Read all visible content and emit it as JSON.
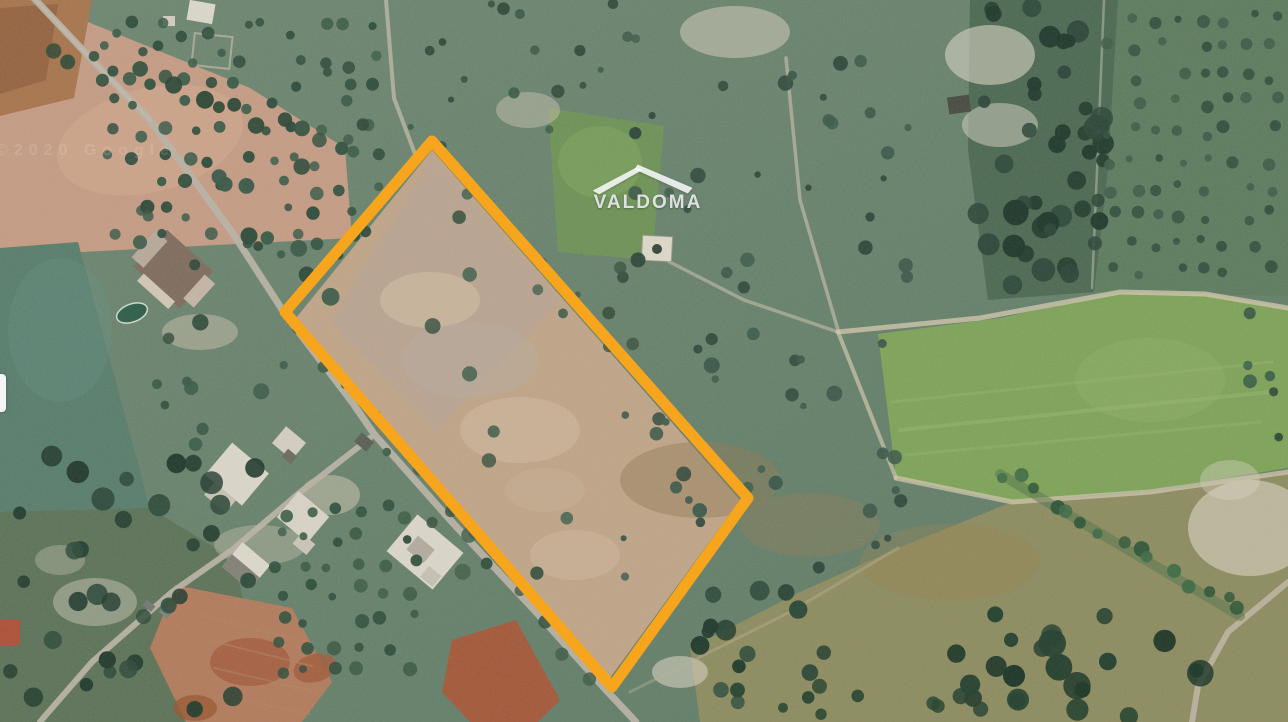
{
  "watermark": {
    "logo_text": "VALDOMA",
    "logo_icon": "roof-icon",
    "color": "#FFFFFF"
  },
  "imagery_credit": {
    "text": "©2020 Google"
  },
  "parcel_outline": {
    "shape": "quadrilateral",
    "color": "#F7A51D",
    "stroke_width": 11,
    "points": "432,141 748,498 612,687 285,312",
    "vertices_px": [
      {
        "x": 432,
        "y": 141
      },
      {
        "x": 748,
        "y": 498
      },
      {
        "x": 612,
        "y": 687
      },
      {
        "x": 285,
        "y": 312
      }
    ]
  },
  "scene": {
    "description": "rural aerial imagery: olive groves, scrubland, dirt roads and a bare-soil parcel",
    "palette": {
      "scrub_green": "#66806B",
      "field_pink": "#C29A83",
      "field_bright_green": "#7DA158",
      "bare_soil": "#BDA387",
      "road_gray": "#B6B0A2",
      "tree_dark": "#2E4A3B",
      "red_soil": "#A2583A",
      "rock_white": "#D6D1C1"
    }
  }
}
